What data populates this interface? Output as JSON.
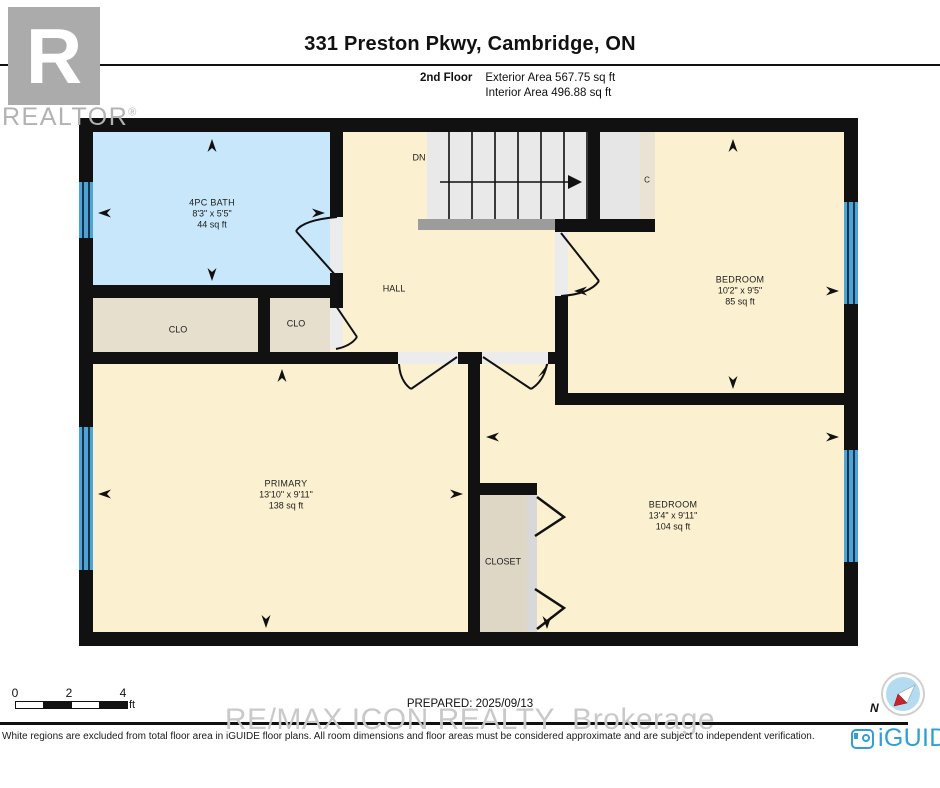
{
  "header": {
    "title": "331 Preston Pkwy, Cambridge, ON",
    "floor_label": "2nd Floor",
    "exterior_area": "Exterior Area 567.75 sq ft",
    "interior_area": "Interior Area 496.88 sq ft"
  },
  "watermarks": {
    "realtor_r": "R",
    "realtor_text": "REALTOR",
    "realtor_reg": "®",
    "brokerage": "RE/MAX ICON REALTY  Brokerage"
  },
  "rooms": {
    "bath": {
      "name": "4PC BATH",
      "dims": "8'3\" x 5'5\"",
      "area": "44 sq ft"
    },
    "hall": {
      "name": "HALL"
    },
    "stairs": {
      "label": "DN"
    },
    "closet_c": {
      "label": "C"
    },
    "clo1": {
      "label": "CLO"
    },
    "clo2": {
      "label": "CLO"
    },
    "bedroom_top": {
      "name": "BEDROOM",
      "dims": "10'2\" x 9'5\"",
      "area": "85 sq ft"
    },
    "primary": {
      "name": "PRIMARY",
      "dims": "13'10\" x 9'11\"",
      "area": "138 sq ft"
    },
    "bedroom_bottom": {
      "name": "BEDROOM",
      "dims": "13'4\" x 9'11\"",
      "area": "104 sq ft"
    },
    "closet": {
      "label": "CLOSET"
    }
  },
  "footer": {
    "scale": {
      "t0": "0",
      "t2": "2",
      "t4": "4",
      "unit": "ft"
    },
    "prepared": "PREPARED: 2025/09/13",
    "disclaimer": "White regions are excluded from total floor area in iGUIDE floor plans. All room dimensions and floor areas must be considered approximate and are subject to independent verification.",
    "brand": "iGUIDE",
    "compass_n": "N"
  },
  "colors": {
    "wall": "#111111",
    "room_fill": "#fbf1d0",
    "bath_fill": "#c9e7fa",
    "closet_fill": "#e7dfce",
    "closet_floor": "#ded7c6",
    "stairs_fill": "#e9e9e9",
    "window": "#4da3d6",
    "brand_blue": "#2f9fd4",
    "compass_red": "#c8232c"
  }
}
